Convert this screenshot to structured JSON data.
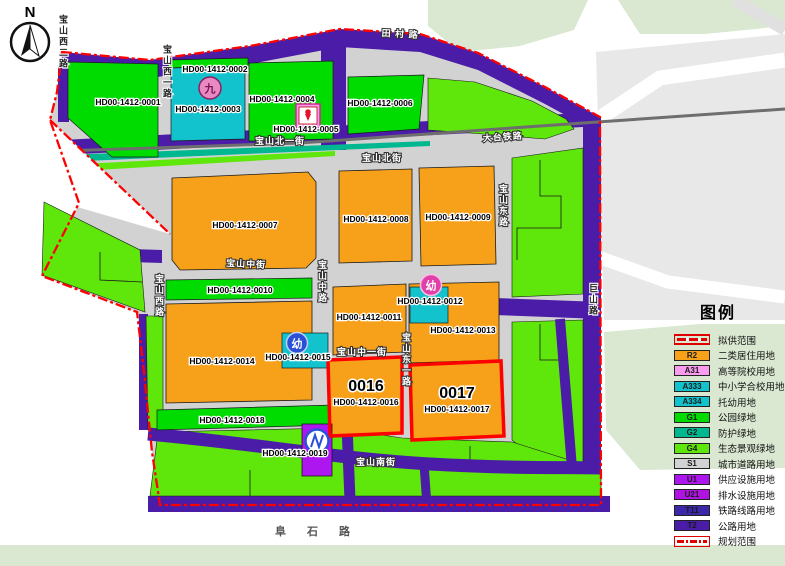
{
  "north_label": "N",
  "legend": {
    "title": "图例",
    "items": [
      {
        "code": "",
        "label": "拟供范围",
        "color": "#ffffff",
        "type": "supply-line"
      },
      {
        "code": "R2",
        "label": "二类居住用地",
        "color": "#F7A11A",
        "type": "fill"
      },
      {
        "code": "A31",
        "label": "高等院校用地",
        "color": "#F99BEF",
        "type": "fill"
      },
      {
        "code": "A333",
        "label": "中小学合校用地",
        "color": "#12C3CE",
        "type": "fill"
      },
      {
        "code": "A334",
        "label": "托幼用地",
        "color": "#12C3CE",
        "type": "fill"
      },
      {
        "code": "G1",
        "label": "公园绿地",
        "color": "#00DC00",
        "type": "fill"
      },
      {
        "code": "G2",
        "label": "防护绿地",
        "color": "#00B890",
        "type": "fill"
      },
      {
        "code": "G4",
        "label": "生态景观绿地",
        "color": "#5FE60A",
        "type": "fill"
      },
      {
        "code": "S1",
        "label": "城市道路用地",
        "color": "#D3D3D3",
        "type": "fill"
      },
      {
        "code": "U1",
        "label": "供应设施用地",
        "color": "#AE16F0",
        "type": "fill"
      },
      {
        "code": "U21",
        "label": "排水设施用地",
        "color": "#B113E3",
        "type": "fill"
      },
      {
        "code": "T11",
        "label": "铁路线路用地",
        "color": "#3A28A8",
        "type": "fill"
      },
      {
        "code": "T2",
        "label": "公路用地",
        "color": "#4A1CA8",
        "type": "fill"
      },
      {
        "code": "",
        "label": "规划范围",
        "color": "#ffffff",
        "type": "plan-line"
      }
    ]
  },
  "parcels": [
    {
      "id": "HD00-1412-0001"
    },
    {
      "id": "HD00-1412-0002"
    },
    {
      "id": "HD00-1412-0003"
    },
    {
      "id": "HD00-1412-0004"
    },
    {
      "id": "HD00-1412-0005"
    },
    {
      "id": "HD00-1412-0006"
    },
    {
      "id": "HD00-1412-0007"
    },
    {
      "id": "HD00-1412-0008"
    },
    {
      "id": "HD00-1412-0009"
    },
    {
      "id": "HD00-1412-0010"
    },
    {
      "id": "HD00-1412-0011"
    },
    {
      "id": "HD00-1412-0012"
    },
    {
      "id": "HD00-1412-0013"
    },
    {
      "id": "HD00-1412-0014"
    },
    {
      "id": "HD00-1412-0015"
    },
    {
      "id": "HD00-1412-0016"
    },
    {
      "id": "HD00-1412-0017"
    },
    {
      "id": "HD00-1412-0018"
    },
    {
      "id": "HD00-1412-0019"
    }
  ],
  "highlights": {
    "no16": "0016",
    "no17": "0017"
  },
  "streets": {
    "baoshan_xi2": "宝山西二路",
    "baoshan_xi1": "宝山西一路",
    "tiancun": "田 村 路",
    "datai_railway": "大台铁路",
    "baoshan_bei": "宝山北街",
    "baoshan_bei1": "宝山北一街",
    "baoshan_zhong_jie": "宝山中街",
    "baoshan_zhong_lu": "宝山中路",
    "baoshan_zhong1": "宝山中一街",
    "baoshan_xi": "宝山西路",
    "baoshan_dong": "宝山东路",
    "baoshan_dong1": "宝山东一路",
    "baoshan_nan": "宝山南街",
    "jushan": "巨山路",
    "fushi": "阜 石 路"
  },
  "icons": {
    "nine": "九",
    "kindergarten": "幼"
  }
}
